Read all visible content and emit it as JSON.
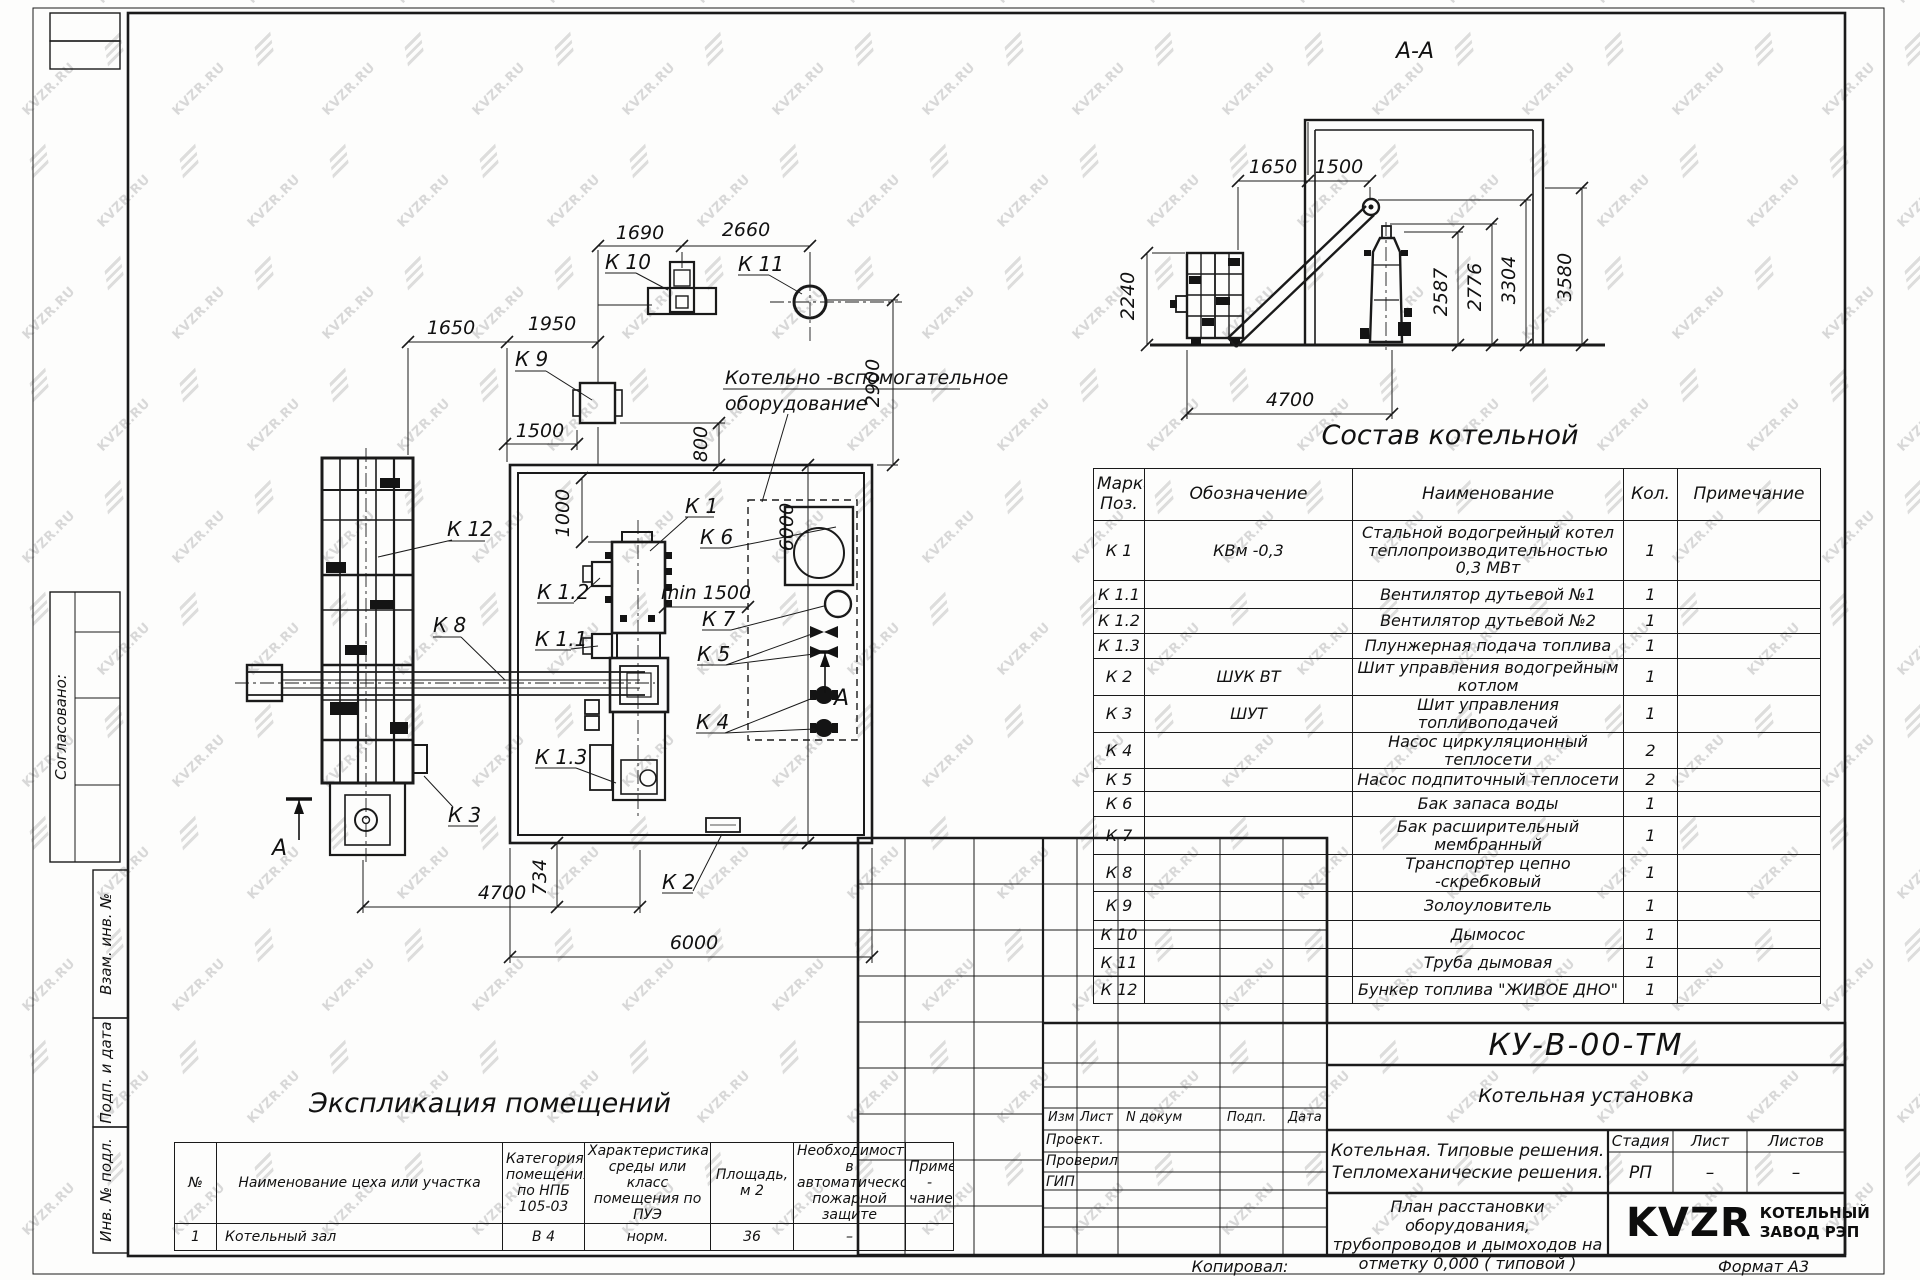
{
  "watermark": {
    "text": "KVZR.RU"
  },
  "sheet": {
    "copied_label": "Копировал:",
    "format_label": "Формат А3"
  },
  "margin": {
    "approved": "Согласовано:",
    "subst_inv": "Взам. инв. №",
    "sign_date": "Подп. и дата",
    "inv_orig": "Инв. № подл."
  },
  "section_view": {
    "title": "А-А",
    "dims": {
      "w1650": "1650",
      "w1500": "1500",
      "h2240": "2240",
      "h2587": "2587",
      "h2776": "2776",
      "h3304": "3304",
      "h3580": "3580",
      "w4700": "4700"
    }
  },
  "plan_view": {
    "equipment_note_line1": "Котельно -вспомогательное",
    "equipment_note_line2": "оборудование",
    "section_letter": "А",
    "labels": {
      "k1": "К 1",
      "k1_1": "К 1.1",
      "k1_2": "К 1.2",
      "k1_3": "К 1.3",
      "k2": "К 2",
      "k3": "К 3",
      "k4": "К 4",
      "k5": "К 5",
      "k6": "К 6",
      "k7": "К 7",
      "k8": "К 8",
      "k9": "К 9",
      "k10": "К 10",
      "k11": "К 11",
      "k12": "К 12"
    },
    "dims": {
      "top_a": "1690",
      "top_b": "2660",
      "left_a": "1650",
      "left_b": "1950",
      "flue_w": "1500",
      "gap_a": "800",
      "gap_b": "1000",
      "min_clear": "min 1500",
      "right_a": "2900",
      "right_b": "6000",
      "bottom_a": "4700",
      "bottom_b": "734",
      "bottom_c": "6000"
    }
  },
  "composition_table": {
    "title": "Состав котельной",
    "headers": {
      "pos": "Марка\nПоз.",
      "designation": "Обозначение",
      "name": "Наименование",
      "qty": "Кол.",
      "note": "Примечание"
    },
    "rows": [
      {
        "pos": "К 1",
        "designation": "КВм -0,3",
        "name": "Стальной водогрейный котел теплопроизводительностью 0,3 МВт",
        "qty": "1",
        "note": ""
      },
      {
        "pos": "К 1.1",
        "designation": "",
        "name": "Вентилятор дутьевой №1",
        "qty": "1",
        "note": ""
      },
      {
        "pos": "К 1.2",
        "designation": "",
        "name": "Вентилятор дутьевой №2",
        "qty": "1",
        "note": ""
      },
      {
        "pos": "К 1.3",
        "designation": "",
        "name": "Плунжерная подача топлива",
        "qty": "1",
        "note": ""
      },
      {
        "pos": "К 2",
        "designation": "ШУК ВТ",
        "name": "Шит управления водогрейным котлом",
        "qty": "1",
        "note": ""
      },
      {
        "pos": "К 3",
        "designation": "ШУТ",
        "name": "Шит управления топливоподачей",
        "qty": "1",
        "note": ""
      },
      {
        "pos": "К 4",
        "designation": "",
        "name": "Насос циркуляционный теплосети",
        "qty": "2",
        "note": ""
      },
      {
        "pos": "К 5",
        "designation": "",
        "name": "Насос подпиточный теплосети",
        "qty": "2",
        "note": ""
      },
      {
        "pos": "К 6",
        "designation": "",
        "name": "Бак запаса воды",
        "qty": "1",
        "note": ""
      },
      {
        "pos": "К 7",
        "designation": "",
        "name": "Бак расширительный мембранный",
        "qty": "1",
        "note": ""
      },
      {
        "pos": "К 8",
        "designation": "",
        "name": "Транспортер цепно -скребковый",
        "qty": "1",
        "note": ""
      },
      {
        "pos": "К 9",
        "designation": "",
        "name": "Золоуловитель",
        "qty": "1",
        "note": ""
      },
      {
        "pos": "К 10",
        "designation": "",
        "name": "Дымосос",
        "qty": "1",
        "note": ""
      },
      {
        "pos": "К 11",
        "designation": "",
        "name": "Труба дымовая",
        "qty": "1",
        "note": ""
      },
      {
        "pos": "К 12",
        "designation": "",
        "name": "Бункер топлива  \"ЖИВОЕ ДНО\"",
        "qty": "1",
        "note": ""
      }
    ]
  },
  "explication_table": {
    "title": "Экспликация помещений",
    "headers": {
      "num": "№",
      "name": "Наименование цеха или участка",
      "category": "Категория\nпомещения\nпо НПБ\n105-03",
      "env": "Характеристика\nсреды или класс\nпомещения по\nПУЭ",
      "area": "Площадь,\nм 2",
      "fire": "Необходимость в\nавтоматической\nпожарной защите",
      "note": "Приме -\nчание"
    },
    "rows": [
      {
        "num": "1",
        "name": "Котельный зал",
        "category": "В 4",
        "env": "норм.",
        "area": "36",
        "fire": "–",
        "note": ""
      }
    ]
  },
  "title_block": {
    "doc_number": "КУ-В-00-ТМ",
    "object_name": "Котельная установка",
    "project_solutions": "Котельная. Типовые решения.\nТепломеханические решения.",
    "sheet_title": "План расстановки оборудования,\nтрубопроводов и дымоходов на\nотметку  0,000  ( типовой )",
    "rev_headers": {
      "izm": "Изм",
      "list": "Лист",
      "ndoc": "N докум",
      "podp": "Подп.",
      "data": "Дата"
    },
    "roles": {
      "r1": "Проект.",
      "r2": "Проверил",
      "r3": "ГИП"
    },
    "stage_label": "Стадия",
    "sheet_label": "Лист",
    "sheets_label": "Листов",
    "stage_value": "РП",
    "sheet_value": "–",
    "sheets_value": "–",
    "logo_text": "KVZR",
    "company": "КОТЕЛЬНЫЙ\nЗАВОД РЭП"
  }
}
